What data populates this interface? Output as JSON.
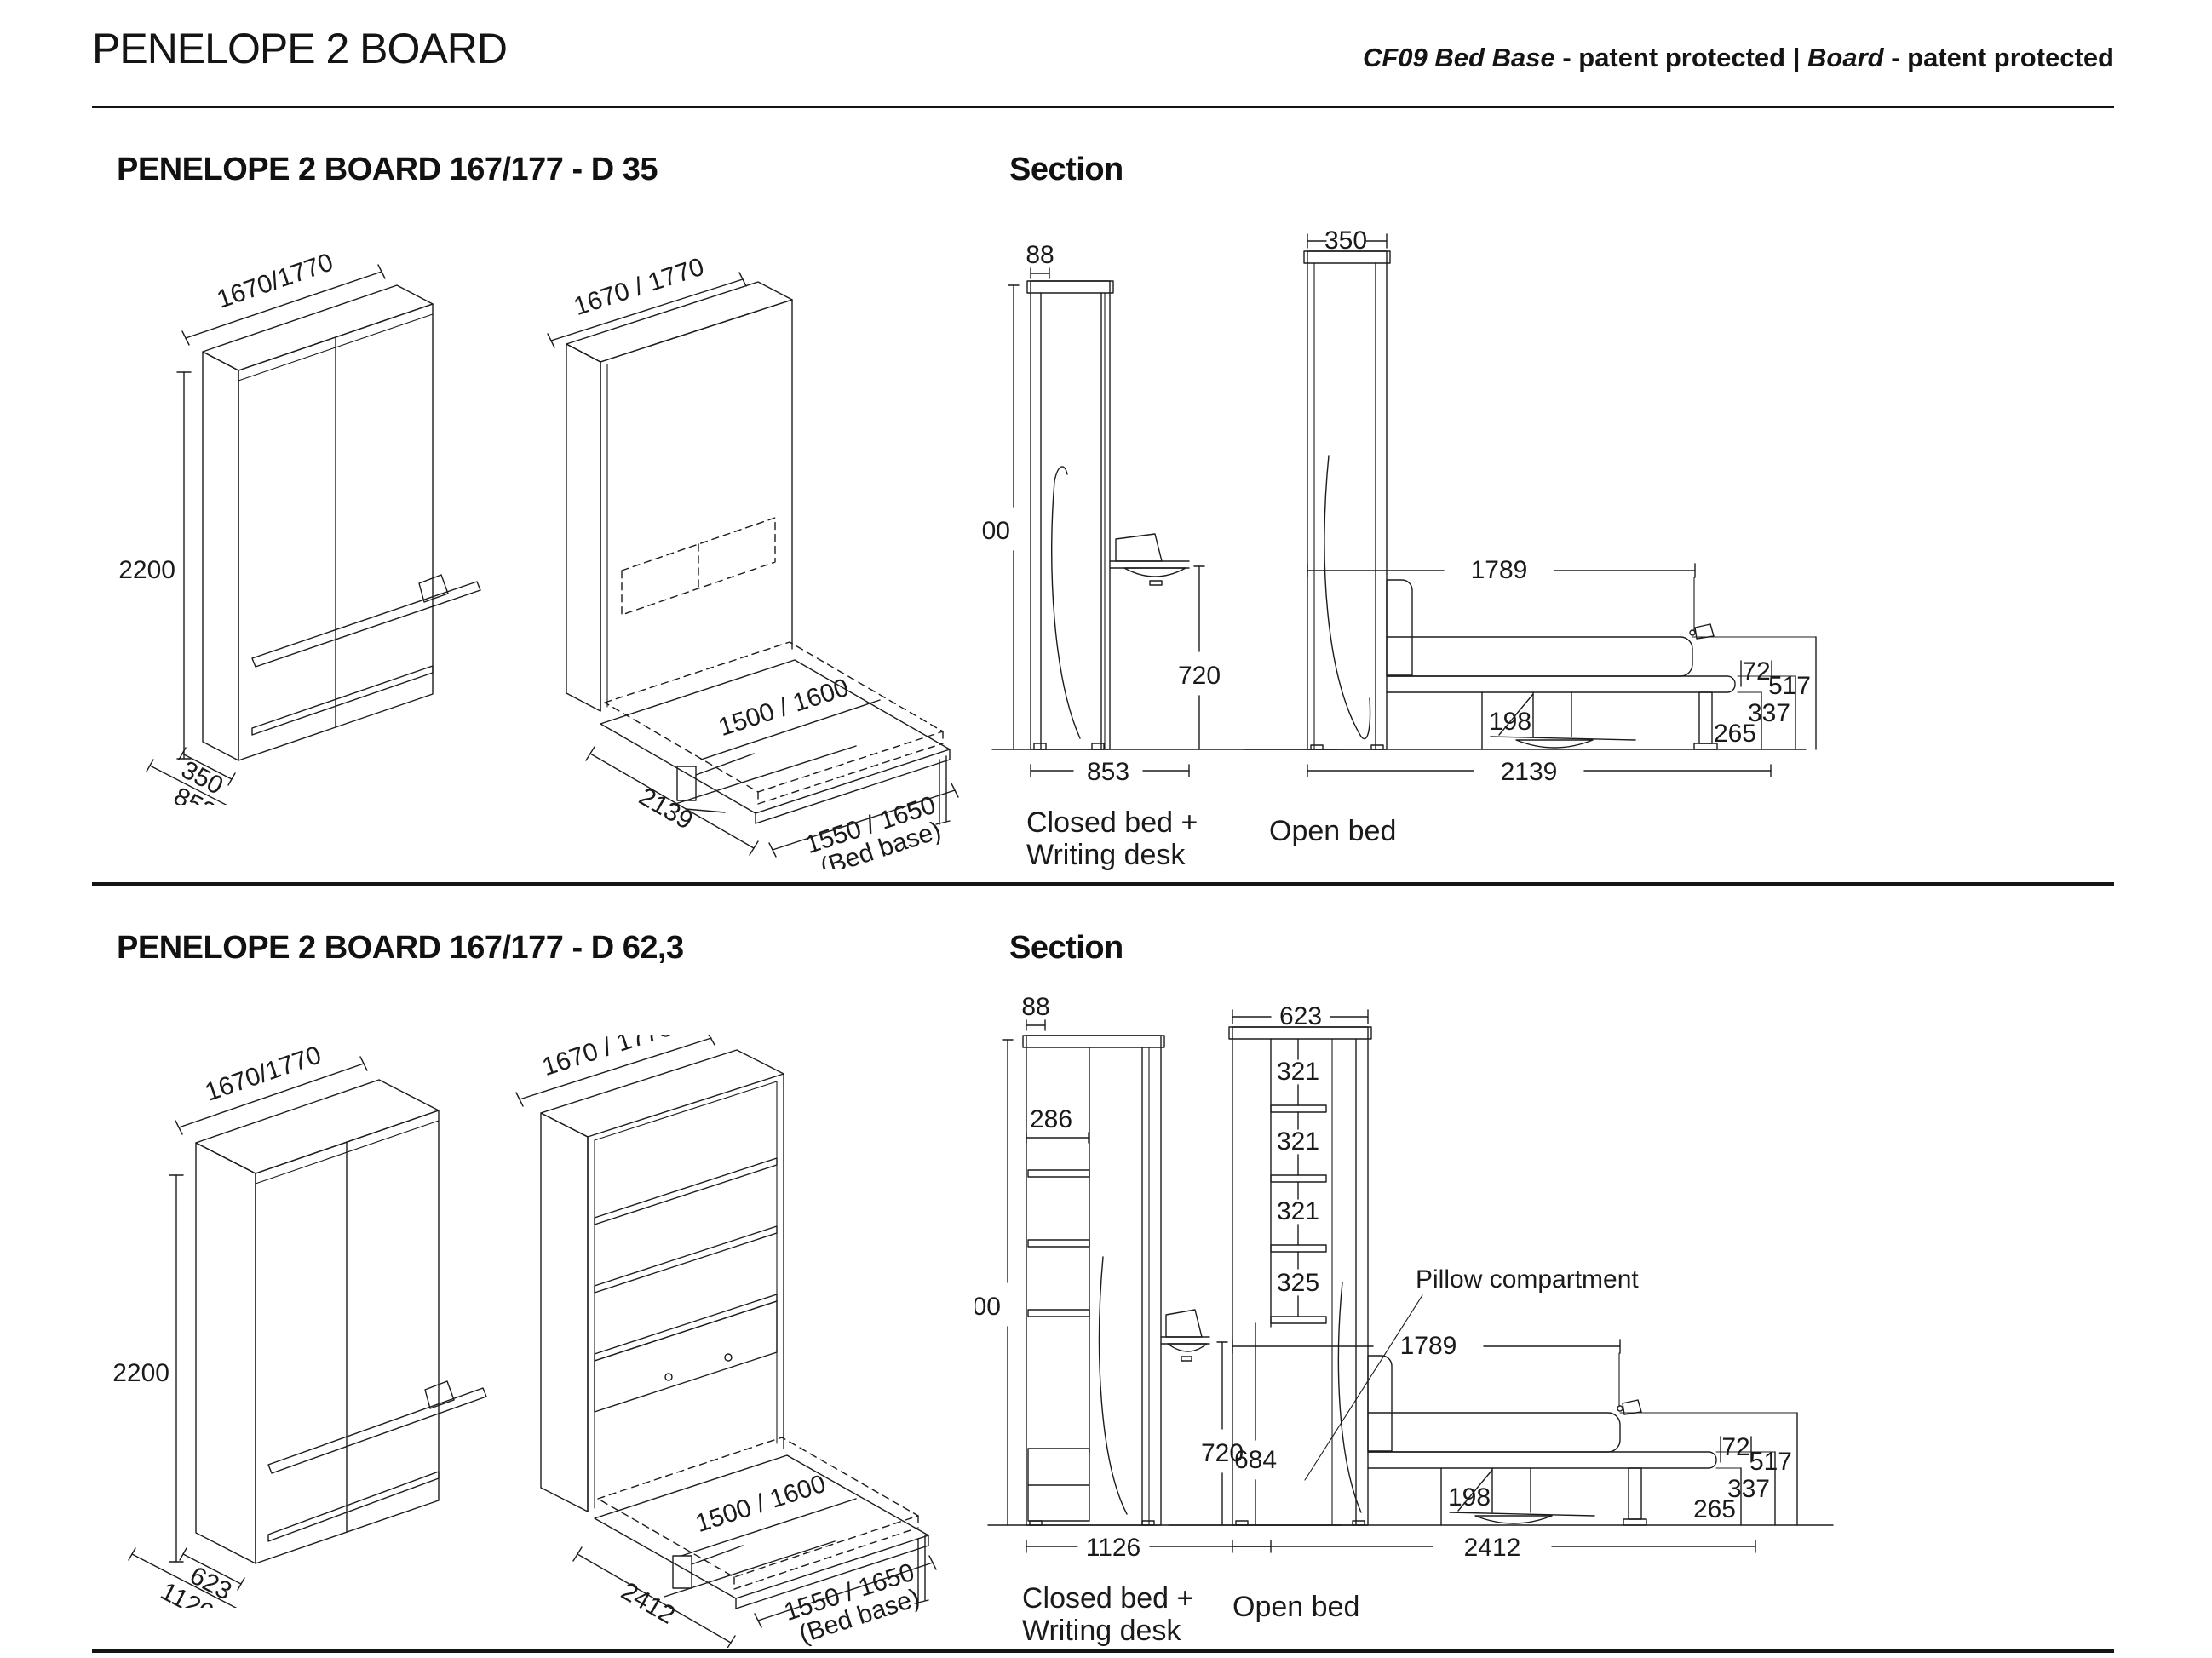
{
  "header": {
    "title": "PENELOPE 2 BOARD",
    "patent_model": "CF09 Bed Base",
    "patent_text1": " - patent protected | ",
    "patent_board": "Board",
    "patent_text2": " - patent protected"
  },
  "sections": [
    {
      "title": "PENELOPE 2 BOARD 167/177 - D 35",
      "section_label": "Section",
      "iso_closed": {
        "width": "1670/1770",
        "height": "2200",
        "depth": "350",
        "total_depth": "853"
      },
      "iso_open": {
        "width": "1670 / 1770",
        "mattress": "1500 / 1600",
        "length": "2139",
        "bed_base": "1550 / 1650",
        "bed_base_note": "(Bed base)"
      },
      "sec_closed": {
        "board_depth": "88",
        "height": "2200",
        "desk_height": "720",
        "total_depth": "853",
        "caption1": "Closed bed +",
        "caption2": "Writing desk"
      },
      "sec_open": {
        "cabinet_depth": "350",
        "mattress_length": "1789",
        "clearance": "198",
        "total_length": "2139",
        "frame_thickness": "72",
        "mattress_height": "517",
        "frame_bottom": "265",
        "frame_top": "337",
        "caption": "Open bed"
      }
    },
    {
      "title": "PENELOPE 2 BOARD 167/177 - D 62,3",
      "section_label": "Section",
      "iso_closed": {
        "width": "1670/1770",
        "height": "2200",
        "depth": "623",
        "total_depth": "1126"
      },
      "iso_open": {
        "width": "1670 / 1770",
        "mattress": "1500 / 1600",
        "length": "2412",
        "bed_base": "1550 / 1650",
        "bed_base_note": "(Bed base)"
      },
      "sec_closed": {
        "board_depth": "88",
        "shelf_depth": "286",
        "height": "2200",
        "desk_height": "720",
        "total_depth": "1126",
        "caption1": "Closed bed +",
        "caption2": "Writing desk"
      },
      "sec_open": {
        "cabinet_depth": "623",
        "shelf1": "321",
        "shelf2": "321",
        "shelf3": "321",
        "shelf4": "325",
        "compartment": "684",
        "pillow_label": "Pillow compartment",
        "mattress_length": "1789",
        "clearance": "198",
        "total_length": "2412",
        "frame_thickness": "72",
        "mattress_height": "517",
        "frame_bottom": "265",
        "frame_top": "337",
        "caption": "Open bed"
      }
    }
  ]
}
